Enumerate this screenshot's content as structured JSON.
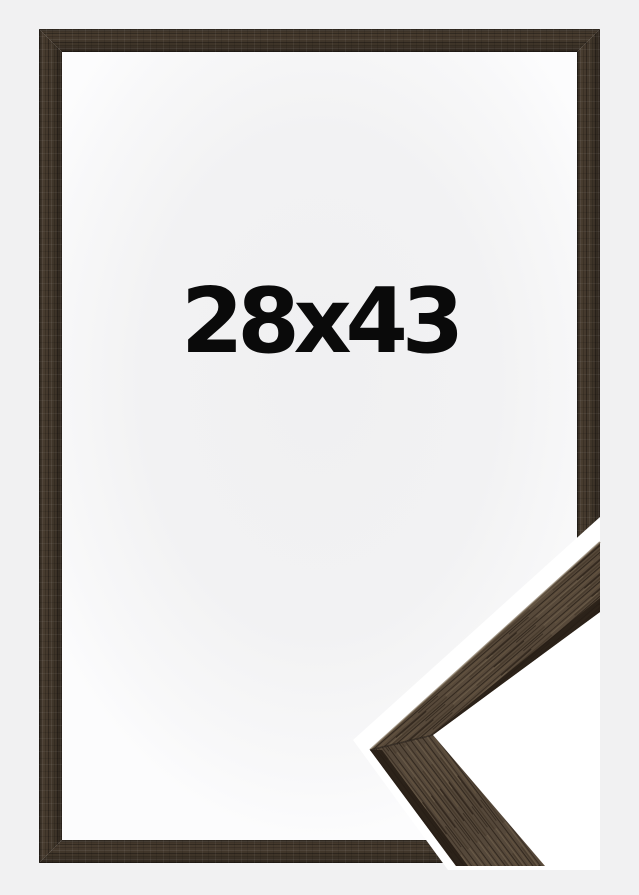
{
  "product_image": {
    "size_label": "28x43",
    "colors": {
      "page_background": "#f1f1f2",
      "opening_background": "#f6f6f7",
      "frame_wood": "#42372b",
      "frame_wood_dark": "#2b231c",
      "frame_wood_light": "#6b5c49",
      "sample_wood": "#57493a",
      "sample_edge_dark": "#251d15",
      "sample_photo_background": "#ffffff",
      "label_text": "#0a0a0a"
    }
  }
}
